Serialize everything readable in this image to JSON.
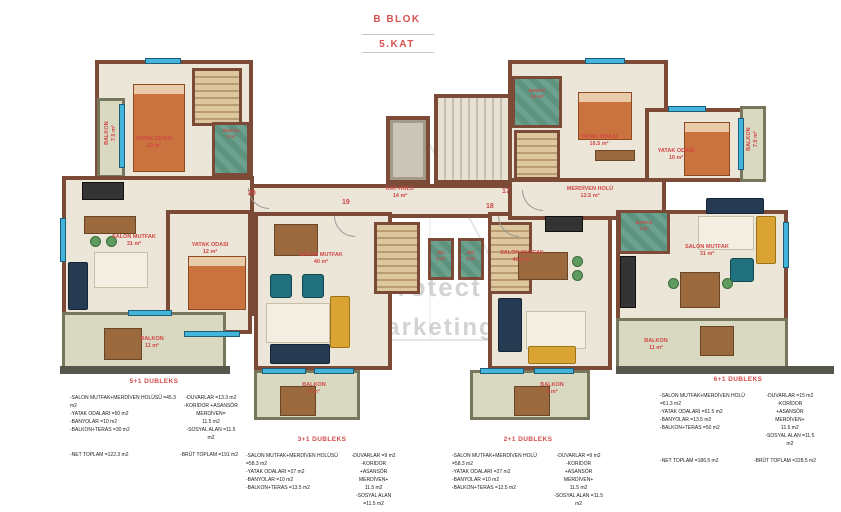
{
  "title": {
    "block": "B BLOK",
    "floor": "5.KAT"
  },
  "watermark": {
    "line1": "Protect",
    "line2": "Marketing"
  },
  "units": {
    "n20": "20",
    "n19": "19",
    "n18": "18",
    "n17": "17"
  },
  "rooms": {
    "balkon75_left": "BALKON\n7.5 m²",
    "yatak10_left": "YATAK ODASI\n10 m²",
    "banyo3_left": "BANYO\n3 m²",
    "salon31_left": "SALON MUTFAK\n31 m²",
    "yatak12_left": "YATAK ODASI\n12 m²",
    "balkon11_left": "BALKON\n11 m²",
    "kat_holu": "KAT HOLÜ\n14 m²",
    "salon40": "SALON MUTFAK\n40 m²",
    "wc_left": "WC\n2 m²",
    "wc_right": "WC\n2 m²",
    "balkon9_left": "BALKON\n9 m²",
    "salon405": "SALON MUTFAK\n40.5 m²",
    "balkon9_right": "BALKON\n9 m²",
    "merdiven_holu": "MERDİVEN HOLÜ\n12.5 m²",
    "banyo35_right": "BANYO\n3.5 m²",
    "yatak165_right": "YATAK ODASI\n16.5 m²",
    "yatak10_right": "YATAK ODASI\n10 m²",
    "balkon75_right": "BALKON\n7.5 m²",
    "banyo4_right": "BANYO\n4 m²",
    "salon31_right": "SALON MUTFAK\n31 m²",
    "balkon11_right": "BALKON\n11 m²"
  },
  "specs": [
    {
      "header": "5+1 DUBLEKS",
      "left": [
        "-SALON MUTFAK+MERDİVEN HOLÜSÜ =45.3 m2",
        "-YATAK ODALARI =50 m2",
        "-BANYOLAR =10 m2",
        "-BALKON+TERAS =30 m2"
      ],
      "right": [
        "-DUVARLAR =13.3 m2",
        "-KORİDOR +ASANSÖR",
        "MERDİVEN=",
        "11.5 m2",
        "-SOSYAL ALAN =11.5 m2"
      ],
      "net": "-NET TOPLAM =122.3 m2",
      "brut": "-BRÜT TOPLAM =191 m2"
    },
    {
      "header": "3+1 DUBLEKS",
      "left": [
        "-SALON MUTFAK+MERDİVEN HOLÜSÜ =58.3 m2",
        "-YATAK ODALARI =27 m2",
        "-BANYOLAR =10 m2",
        "-BALKON+TERAS =13.5 m2"
      ],
      "right": [
        "-DUVARLAR =9 m2",
        "-KORİDOR +ASANSÖR",
        "MERDİVEN+",
        "11.5 m2",
        "-SOSYAL ALAN =11.5 m2"
      ],
      "net": "-NET TOPLAM =108 m2",
      "brut": "-BRÜT TOPLAM =132 m2"
    },
    {
      "header": "2+1 DUBLEKS",
      "left": [
        "-SALON MUTFAK+MERDİVEN HOLÜ =58.3 m2",
        "-YATAK ODALARI =27 m2",
        "-BANYOLAR =10 m2",
        "-BALKON+TERAS =12.5 m2"
      ],
      "right": [
        "-DUVARLAR =9 m2",
        "-KORİDOR +ASANSÖR",
        "MERDİVEN+",
        "11.5 m2",
        "-SOSYAL ALAN =11.5 m2"
      ],
      "net": "-NET TOPLAM =108 m2",
      "brut": "-BRÜT TOPLAM =132 m2"
    },
    {
      "header": "6+1 DUBLEKS",
      "left": [
        "-SALON MUTFAK+MERDİVEN HOLÜ =61.3 m2",
        "-YATAK ODALARI =61.5 m2",
        "-BANYOLAR =13.5 m2",
        "-BALKON+TERAS =50 m2"
      ],
      "right": [
        "-DUVARLAR =15 m2",
        "-KORİDOR +ASANSÖR",
        "MERDİVEN+",
        "11.5 m2",
        "-SOSYAL ALAN =11.5 m2"
      ],
      "net": "-NET TOPLAM =186.5 m2",
      "brut": "-BRÜT TOPLAM =228.5 m2"
    }
  ],
  "colors": {
    "wall": "#7b4b38",
    "floor": "#ece6d8",
    "balcony": "#d9d9c1",
    "bathroom": "#6ba18e",
    "window": "#44b5da",
    "label_red": "#cf4646",
    "title_red": "#d85252"
  }
}
